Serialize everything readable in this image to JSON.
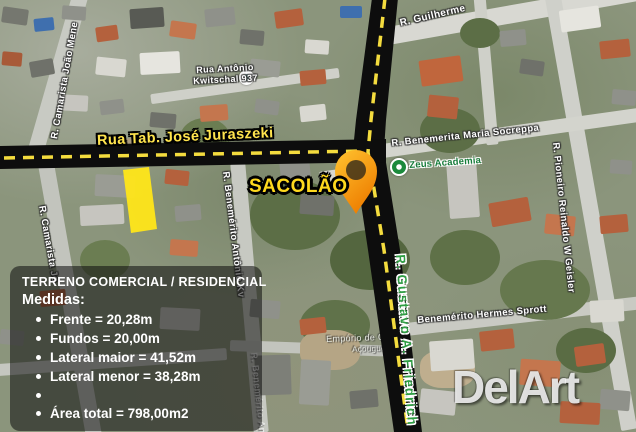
{
  "colors": {
    "road-black": "#0d0d0d",
    "dash-yellow": "#f4dc3e",
    "plot-yellow": "#ffe619",
    "pin-top": "#ffc430",
    "pin-bottom": "#ee7d00",
    "street-yellow": "#ffe44d",
    "sacolao-yellow": "#ffd91e",
    "green-street": "#2f9e44",
    "info-bg": "rgba(12,12,12,0.55)"
  },
  "overlay": {
    "main_street_label": "Rua Tab. José Juraszeki",
    "sacolao_label": "SACOLÃO"
  },
  "map_labels": [
    {
      "text": "R. Guilherme",
      "x": 399,
      "y": 19,
      "rot": -13,
      "style": "white",
      "size": 10,
      "layer": "under"
    },
    {
      "text": "Rua Antônio",
      "x": 196,
      "y": 66,
      "rot": -3,
      "style": "white",
      "size": 9,
      "layer": "under"
    },
    {
      "text": "Kwitschal 937",
      "x": 193,
      "y": 77,
      "rot": -3,
      "style": "white",
      "size": 9,
      "layer": "under"
    },
    {
      "text": "R. Camarista João Mene",
      "x": 50,
      "y": 138,
      "rot": -80,
      "style": "white",
      "size": 9.5,
      "layer": "under"
    },
    {
      "text": "R. Benemérito Antônio Kv",
      "x": 230,
      "y": 171,
      "rot": 83,
      "style": "white",
      "size": 9.5,
      "layer": "under"
    },
    {
      "text": "R. Benemerita Maria Socreppa",
      "x": 391,
      "y": 139,
      "rot": -6,
      "style": "white",
      "size": 9.5,
      "layer": "under"
    },
    {
      "text": "Zeus Academia",
      "x": 409,
      "y": 161,
      "rot": -4,
      "style": "green-sm",
      "size": 9.5,
      "layer": "under"
    },
    {
      "text": "R. Pioneiro Reinaldo W Geisler",
      "x": 560,
      "y": 142,
      "rot": 84,
      "style": "white",
      "size": 9.5,
      "layer": "under"
    },
    {
      "text": "Benemérito Hermes Sprott",
      "x": 417,
      "y": 316,
      "rot": -5,
      "style": "white",
      "size": 9.5,
      "layer": "under"
    },
    {
      "text": "Empório de Carne",
      "x": 326,
      "y": 335,
      "rot": -2,
      "style": "gray",
      "size": 9,
      "layer": "under"
    },
    {
      "text": "Açougue",
      "x": 352,
      "y": 346,
      "rot": -2,
      "style": "gray",
      "size": 8,
      "layer": "under"
    },
    {
      "text": "R. Camarista Jo",
      "x": 46,
      "y": 205,
      "rot": 80,
      "style": "white",
      "size": 9.5,
      "layer": "under"
    },
    {
      "text": "R. Benemérito An",
      "x": 258,
      "y": 352,
      "rot": 84,
      "style": "faint",
      "size": 9,
      "layer": "under"
    },
    {
      "text": "R. Gustavo A. Friedrich",
      "x": 407,
      "y": 254,
      "rot": 86,
      "style": "green-lg",
      "size": 13,
      "layer": "over"
    }
  ],
  "info_box": {
    "title": "TERRENO COMERCIAL / RESIDENCIAL",
    "subtitle": "Medidas:",
    "items": [
      "Frente = 20,28m",
      "Fundos = 20,00m",
      "Lateral maior = 41,52m",
      "Lateral menor = 38,28m",
      "",
      "Área total = 798,00m2"
    ]
  },
  "watermark": {
    "text": "DelArt"
  }
}
